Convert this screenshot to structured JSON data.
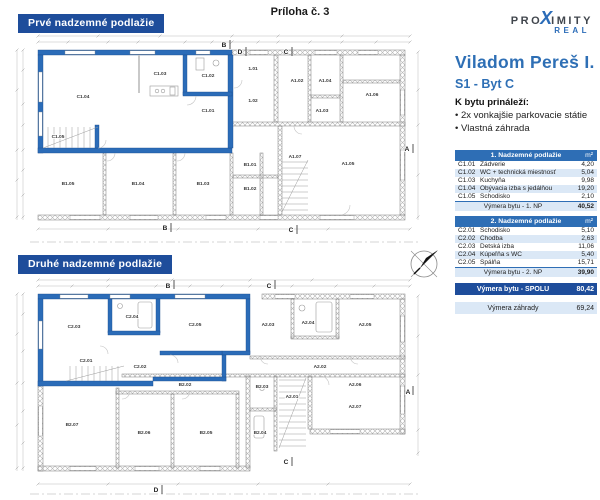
{
  "page": {
    "attachment_label": "Príloha č. 3"
  },
  "logo": {
    "pro": "PRO",
    "x": "X",
    "imity": "IMITY",
    "real": "REAL"
  },
  "panel": {
    "title": "Viladom Pereš I.",
    "subtitle": "S1 - Byt C",
    "includes_heading": "K bytu prináleží:",
    "includes": [
      "• 2x vonkajšie parkovacie státie",
      "• Vlastná záhrada"
    ],
    "tables": [
      {
        "header": "1. Nadzemné podlažie",
        "unit": "m²",
        "rows": [
          [
            "C1.01",
            "Zádverie",
            "4,20"
          ],
          [
            "C1.02",
            "WC + technická miestnosť",
            "5,04"
          ],
          [
            "C1.03",
            "Kuchyňa",
            "9,98"
          ],
          [
            "C1.04",
            "Obývacia izba s jedálňou",
            "19,20"
          ],
          [
            "C1.05",
            "Schodisko",
            "2,10"
          ]
        ],
        "summary_label": "Výmera bytu - 1. NP",
        "summary_value": "40,52"
      },
      {
        "header": "2. Nadzemné podlažie",
        "unit": "m²",
        "rows": [
          [
            "C2.01",
            "Schodisko",
            "5,10"
          ],
          [
            "C2.02",
            "Chodba",
            "2,63"
          ],
          [
            "C2.03",
            "Detská izba",
            "11,06"
          ],
          [
            "C2.04",
            "Kúpeľňa s WC",
            "5,40"
          ],
          [
            "C2.05",
            "Spálňa",
            "15,71"
          ]
        ],
        "summary_label": "Výmera bytu - 2. NP",
        "summary_value": "39,90"
      }
    ],
    "total_label": "Výmera bytu - SPOLU",
    "total_value": "80,42",
    "garden_label": "Výmera záhrady",
    "garden_value": "69,24"
  },
  "floor1": {
    "title": "Prvé nadzemné podlažie",
    "rooms": [
      "C1.04",
      "C1.03",
      "C1.02",
      "C1.01",
      "C1.05",
      "1.01",
      "1.02",
      "A1.02",
      "A1.04",
      "A1.06",
      "A1.03",
      "A1.05",
      "A1.07",
      "B1.01",
      "B1.02",
      "B1.03",
      "B1.04",
      "B1.05"
    ],
    "sections": [
      "B",
      "D",
      "C",
      "A",
      "B",
      "C"
    ]
  },
  "floor2": {
    "title": "Druhé nadzemné podlažie",
    "rooms": [
      "C2.03",
      "C2.04",
      "C2.05",
      "C2.02",
      "C2.01",
      "A2.03",
      "A2.04",
      "A2.05",
      "A2.02",
      "A2.06",
      "A2.01",
      "A2.07",
      "B2.02",
      "B2.03",
      "B2.04",
      "B2.05",
      "B2.06",
      "B2.07"
    ],
    "sections": [
      "B",
      "C",
      "A",
      "C",
      "D"
    ]
  },
  "colors": {
    "navy": "#1e4d9b",
    "table_header_blue": "#2e6eb5",
    "row_alt": "#dbe8f6",
    "wall_blue": "#2b6cb8",
    "accent_blue": "#2e6fb5"
  }
}
